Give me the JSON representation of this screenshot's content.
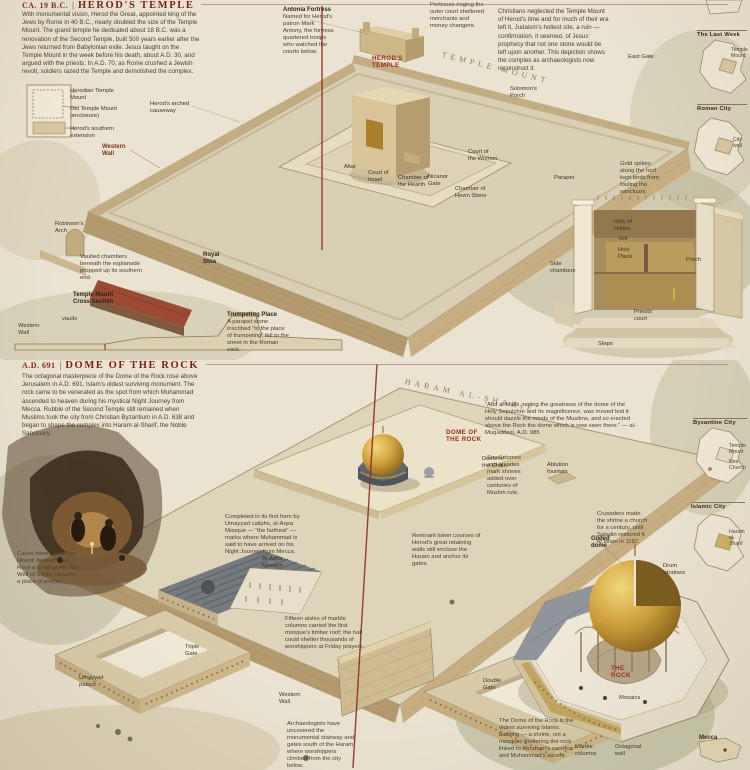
{
  "palette": {
    "parchment": "#eae3d1",
    "ink": "#3f3525",
    "accent_red": "#8e2b20",
    "header_red": "#7c1f16",
    "gold": "#c49434",
    "stone": "#c8b48c",
    "slate": "#5d6671",
    "green_wash": "#99a077"
  },
  "herod": {
    "era": "CA. 19 B.C.",
    "sep": "|",
    "title": "HEROD'S TEMPLE",
    "intro": "With monumental vision, Herod the Great, appointed king of the Jews by Rome in 40 B.C., nearly doubled the size of the Temple Mount. The grand temple he dedicated about 18 B.C. was a renovation of the Second Temple, built 500 years earlier after the Jews returned from Babylonian exile. Jesus taught on the Temple Mount in the week before his death, about A.D. 30, and argued with the priests. In A.D. 70, as Rome crushed a Jewish revolt, soldiers razed the Temple and demolished the complex.",
    "right_note": "Christians neglected the Temple Mount of Herod's time and for much of their era left it, Judaism's holiest site, a ruin — confirmation, it seemed, of Jesus' prophecy that not one stone would be left upon another. This depiction shows the complex as archaeologists now reconstruct it."
  },
  "dome": {
    "era": "A.D. 691",
    "sep": "|",
    "title": "DOME OF THE ROCK",
    "intro": "The octagonal masterpiece of the Dome of the Rock rose above Jerusalem in A.D. 691, Islam's oldest surviving monument. The rock came to be venerated as the spot from which Muhammad ascended to heaven during his mystical Night Journey from Mecca. Rubble of the Second Temple still remained when Muslims took the city from Christian Byzantium in A.D. 638 and began to shape the complex into Haram al-Sharif, the Noble Sanctuary."
  },
  "callouts": [
    {
      "x": 283,
      "y": 7,
      "w": 52,
      "cls": "b",
      "name": "antonia-fortress-label",
      "text": "Antonia Fortress"
    },
    {
      "x": 283,
      "y": 14,
      "w": 52,
      "cls": "cap",
      "name": "antonia-fortress-caption",
      "text": "Named for Herod's patron Mark Antony, the fortress quartered troops who watched the courts below."
    },
    {
      "x": 430,
      "y": 2,
      "w": 58,
      "cls": "cap",
      "name": "portico-caption",
      "text": "Porticoes ringing the outer court sheltered merchants and money changers."
    },
    {
      "x": 372,
      "y": 55,
      "w": 30,
      "cls": "r",
      "name": "herods-temple-label",
      "text": "Herod's Temple"
    },
    {
      "x": 443,
      "y": 50,
      "cls": "sp",
      "rot": 14,
      "name": "temple-mount-inscription",
      "text": "TEMPLE MOUNT"
    },
    {
      "x": 628,
      "y": 54,
      "w": 26,
      "cls": "p",
      "name": "east-gate-label",
      "text": "East Gate"
    },
    {
      "x": 510,
      "y": 86,
      "w": 32,
      "cls": "p",
      "name": "solomons-porch-label",
      "text": "Solomon's Porch"
    },
    {
      "x": 344,
      "y": 164,
      "w": 20,
      "cls": "p",
      "name": "altar-label",
      "text": "Altar"
    },
    {
      "x": 368,
      "y": 170,
      "w": 26,
      "cls": "p",
      "name": "court-of-israel-label",
      "text": "Court of Israel"
    },
    {
      "x": 398,
      "y": 175,
      "w": 34,
      "cls": "p",
      "name": "chamber-of-the-hearth-label",
      "text": "Chamber of the Hearth"
    },
    {
      "x": 428,
      "y": 174,
      "w": 26,
      "cls": "p",
      "name": "nicanor-gate-label",
      "text": "Nicanor Gate"
    },
    {
      "x": 455,
      "y": 186,
      "w": 36,
      "cls": "p",
      "name": "chamber-of-hewn-stone-label",
      "text": "Chamber of Hewn Stone"
    },
    {
      "x": 468,
      "y": 149,
      "w": 30,
      "cls": "p",
      "name": "court-of-the-women-label",
      "text": "Court of the Women"
    },
    {
      "x": 150,
      "y": 101,
      "w": 42,
      "cls": "p",
      "name": "arched-causeway-label",
      "text": "Herod's arched causeway"
    },
    {
      "x": 102,
      "y": 144,
      "w": 32,
      "cls": "rb",
      "name": "western-wall-label",
      "text": "Western Wall"
    },
    {
      "x": 203,
      "y": 252,
      "w": 30,
      "cls": "b",
      "name": "royal-stoa-label",
      "text": "Royal Stoa"
    },
    {
      "x": 55,
      "y": 221,
      "w": 34,
      "cls": "p",
      "name": "robinsons-arch-label",
      "text": "Robinson's Arch"
    },
    {
      "x": 227,
      "y": 312,
      "w": 60,
      "cls": "b",
      "name": "trumpeting-place-label",
      "text": "Trumpeting Place"
    },
    {
      "x": 227,
      "y": 319,
      "w": 62,
      "cls": "cap",
      "name": "trumpeting-place-caption",
      "text": "A parapet stone inscribed “to the place of trumpeting” fell to the street in the Roman sack."
    },
    {
      "x": 80,
      "y": 254,
      "w": 62,
      "cls": "cap",
      "name": "vaults-caption",
      "text": "Vaulted chambers beneath the esplanade propped up its southern end."
    },
    {
      "x": 73,
      "y": 292,
      "w": 58,
      "cls": "b",
      "name": "cross-section-title",
      "text": "Temple Mount Cross Section"
    },
    {
      "x": 18,
      "y": 323,
      "w": 30,
      "cls": "p",
      "name": "cross-section-western-wall-label",
      "text": "Western Wall"
    },
    {
      "x": 62,
      "y": 316,
      "w": 20,
      "cls": "p",
      "name": "cross-section-vaults-label",
      "text": "vaults"
    },
    {
      "x": 620,
      "y": 161,
      "w": 44,
      "cls": "cap",
      "name": "roof-spikes-caption",
      "text": "Gold spikes along the roof kept birds from fouling the sanctuary."
    },
    {
      "x": 554,
      "y": 175,
      "w": 26,
      "cls": "p",
      "name": "parapet-label",
      "text": "Parapet"
    },
    {
      "x": 614,
      "y": 219,
      "w": 30,
      "cls": "p",
      "name": "holy-of-holies-label",
      "text": "Holy of Holies"
    },
    {
      "x": 618,
      "y": 236,
      "w": 20,
      "cls": "p",
      "name": "veil-label",
      "text": "Veil"
    },
    {
      "x": 618,
      "y": 247,
      "w": 26,
      "cls": "p",
      "name": "holy-place-label",
      "text": "Holy Place"
    },
    {
      "x": 550,
      "y": 261,
      "w": 30,
      "cls": "p",
      "name": "side-chambers-label",
      "text": "Side chambers"
    },
    {
      "x": 686,
      "y": 257,
      "w": 22,
      "cls": "p",
      "name": "porch-label",
      "text": "Porch"
    },
    {
      "x": 634,
      "y": 309,
      "w": 32,
      "cls": "p",
      "name": "priests-court-label",
      "text": "Priests' court"
    },
    {
      "x": 598,
      "y": 341,
      "w": 22,
      "cls": "p",
      "name": "steps-label",
      "text": "Steps"
    },
    {
      "x": 70,
      "y": 88,
      "w": 56,
      "cls": "p",
      "name": "plan-herodian-mount-label",
      "text": "Herodian Temple Mount"
    },
    {
      "x": 70,
      "y": 106,
      "w": 52,
      "cls": "p",
      "name": "plan-old-mount-label",
      "text": "Old Temple Mount (enclosure)"
    },
    {
      "x": 70,
      "y": 126,
      "w": 52,
      "cls": "p",
      "name": "plan-extension-label",
      "text": "Herod's southern extension"
    },
    {
      "x": 697,
      "y": 30,
      "w": 50,
      "cls": "mt",
      "name": "map-last-week-title",
      "text": "The Last Week"
    },
    {
      "x": 697,
      "y": 104,
      "w": 50,
      "cls": "mt",
      "name": "map-roman-city-title",
      "text": "Roman City"
    },
    {
      "x": 731,
      "y": 48,
      "w": 17,
      "cls": "ps",
      "name": "map-last-week-side-label",
      "text": "Temple Mount"
    },
    {
      "x": 733,
      "y": 138,
      "w": 15,
      "cls": "ps",
      "name": "map-roman-side-label",
      "text": "City wall"
    },
    {
      "x": 406,
      "y": 377,
      "cls": "sp",
      "rot": 12,
      "name": "haram-al-sharif-inscription",
      "text": "HARAM AL-SHARIF"
    },
    {
      "x": 446,
      "y": 429,
      "w": 38,
      "cls": "r",
      "name": "dome-of-the-rock-label",
      "text": "Dome of the Rock"
    },
    {
      "x": 482,
      "y": 456,
      "w": 30,
      "cls": "p",
      "name": "dome-of-the-chain-label",
      "text": "Dome of the Chain"
    },
    {
      "x": 485,
      "y": 402,
      "w": 152,
      "cls": "cap",
      "name": "muqaddasi-quote",
      "text": "“Abd al-Malik, noting the greatness of the dome of the Holy Sepulchre and its magnificence, was moved lest it should dazzle the minds of the Muslims, and so erected above the Rock the dome which is now seen there.” — al-Muqaddasi, A.D. 985"
    },
    {
      "x": 487,
      "y": 455,
      "w": 42,
      "cls": "cap",
      "name": "later-shrines-caption",
      "text": "Small domes and arcades mark shrines added over centuries of Muslim rule."
    },
    {
      "x": 597,
      "y": 511,
      "w": 52,
      "cls": "cap",
      "name": "crusader-caption",
      "text": "Crusaders made the shrine a church for a century, until Saladin restored it to Islam in 1187."
    },
    {
      "x": 547,
      "y": 462,
      "w": 34,
      "cls": "p",
      "name": "ablution-fountain-label",
      "text": "Ablution fountain"
    },
    {
      "x": 412,
      "y": 533,
      "w": 72,
      "cls": "cap",
      "name": "retaining-wall-caption",
      "text": "Remnant lower courses of Herod's great retaining walls still enclose the Haram and anchor its gates."
    },
    {
      "x": 225,
      "y": 514,
      "w": 80,
      "cls": "cap",
      "name": "al-aqsa-caption",
      "text": "Completed in its first form by Umayyad caliphs, al-Aqsa Mosque — “the farthest” — marks where Muhammad is said to have arrived on his Night Journey from Mecca."
    },
    {
      "x": 262,
      "y": 556,
      "w": 30,
      "cls": "p",
      "name": "al-aqsa-mosque-label",
      "text": "Al-Aqsa Mosque"
    },
    {
      "x": 285,
      "y": 616,
      "w": 80,
      "cls": "cap",
      "name": "al-aqsa-interior-caption",
      "text": "Fifteen aisles of marble columns carried the first mosque's timber roof; the hall could shelter thousands of worshippers at Friday prayers."
    },
    {
      "x": 79,
      "y": 675,
      "w": 36,
      "cls": "p",
      "name": "umayyad-palace-label",
      "text": "Umayyad palace"
    },
    {
      "x": 185,
      "y": 644,
      "w": 26,
      "cls": "p",
      "name": "triple-gate-label",
      "text": "Triple Gate"
    },
    {
      "x": 483,
      "y": 678,
      "w": 28,
      "cls": "p",
      "name": "double-gate-label",
      "text": "Double Gate"
    },
    {
      "x": 279,
      "y": 692,
      "w": 28,
      "cls": "p",
      "name": "western-wall-bottom-label",
      "text": "Western Wall"
    },
    {
      "x": 287,
      "y": 721,
      "w": 70,
      "cls": "cap",
      "name": "excavation-caption",
      "text": "Archaeologists have uncovered the monumental stairway and gates south of the Haram where worshippers climbed from the city below."
    },
    {
      "x": 499,
      "y": 718,
      "w": 82,
      "cls": "cap",
      "name": "dome-oldest-caption",
      "text": "The Dome of the Rock is the oldest surviving Islamic building — a shrine, not a mosque, sheltering the rock linked to Abraham's sacrifice and Muhammad's ascent."
    },
    {
      "x": 17,
      "y": 551,
      "w": 62,
      "cls": "cap",
      "name": "cave-caption",
      "text": "Caves honeycomb the Mount: beneath the Rock a small grotto, the Well of Souls, became a place of prayer."
    },
    {
      "x": 591,
      "y": 536,
      "w": 32,
      "cls": "b",
      "name": "gilded-dome-label",
      "text": "Gilded dome"
    },
    {
      "x": 663,
      "y": 563,
      "w": 30,
      "cls": "p",
      "name": "drum-windows-label",
      "text": "Drum windows"
    },
    {
      "x": 611,
      "y": 665,
      "w": 28,
      "cls": "r",
      "name": "the-rock-label",
      "text": "The Rock"
    },
    {
      "x": 619,
      "y": 695,
      "w": 24,
      "cls": "p",
      "name": "mosaics-label",
      "text": "Mosaics"
    },
    {
      "x": 575,
      "y": 744,
      "w": 34,
      "cls": "p",
      "name": "marble-columns-label",
      "text": "Marble columns"
    },
    {
      "x": 615,
      "y": 744,
      "w": 38,
      "cls": "p",
      "name": "octagonal-wall-label",
      "text": "Octagonal wall"
    },
    {
      "x": 699,
      "y": 735,
      "w": 30,
      "cls": "b",
      "name": "mecca-label",
      "text": "Mecca"
    },
    {
      "x": 693,
      "y": 418,
      "w": 54,
      "cls": "mt",
      "name": "map-byzantine-title",
      "text": "Byzantine City"
    },
    {
      "x": 691,
      "y": 502,
      "w": 54,
      "cls": "mt",
      "name": "map-islamic-title",
      "text": "Islamic City"
    },
    {
      "x": 729,
      "y": 444,
      "w": 18,
      "cls": "ps",
      "name": "map-byzantine-side-label",
      "text": "Temple Mount"
    },
    {
      "x": 729,
      "y": 460,
      "w": 18,
      "cls": "ps",
      "name": "map-byzantine-side-label-2",
      "text": "Nea Church"
    },
    {
      "x": 729,
      "y": 530,
      "w": 18,
      "cls": "ps",
      "name": "map-islamic-side-label",
      "text": "Haram al-Sharif"
    }
  ]
}
